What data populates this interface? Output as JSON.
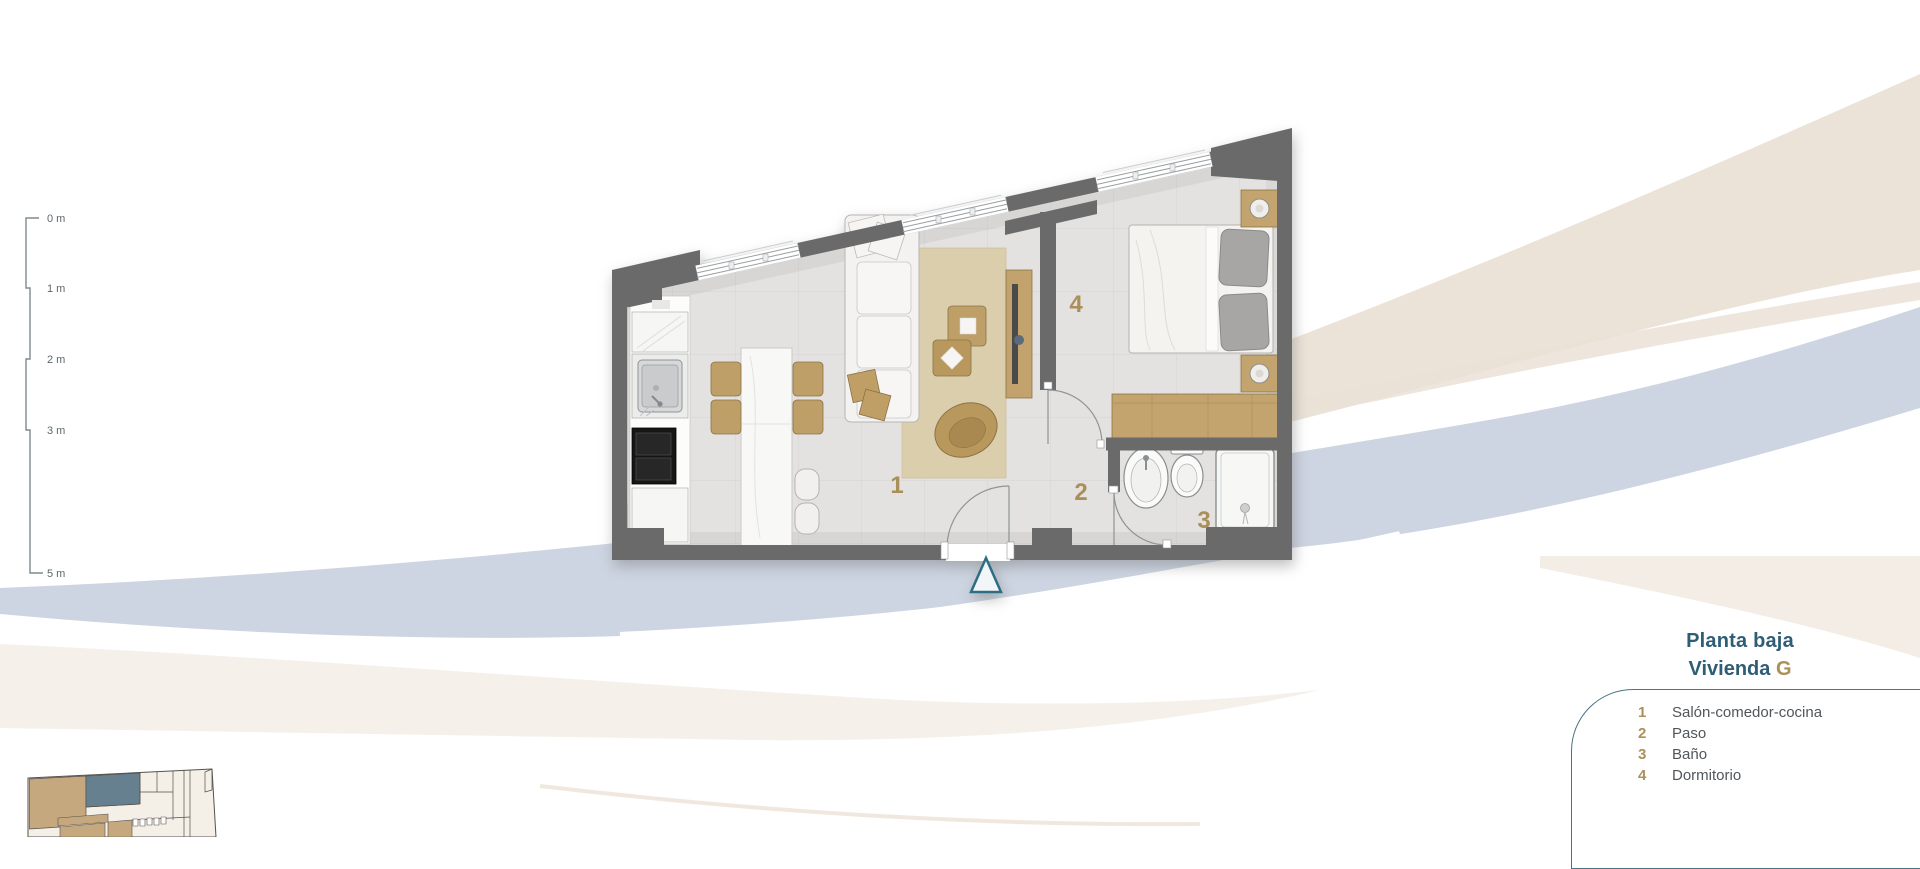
{
  "title": {
    "floor": "Planta baja",
    "unit_prefix": "Vivienda",
    "unit_letter": "G"
  },
  "legend": {
    "items": [
      {
        "number": "1",
        "label": "Salón-comedor-cocina"
      },
      {
        "number": "2",
        "label": "Paso"
      },
      {
        "number": "3",
        "label": "Baño"
      },
      {
        "number": "4",
        "label": "Dormitorio"
      }
    ]
  },
  "scale_ruler": {
    "ticks": [
      "0 m",
      "1 m",
      "2 m",
      "3 m",
      "5 m"
    ]
  },
  "floor_plan": {
    "room_numbers": {
      "salon": "1",
      "paso": "2",
      "bano": "3",
      "dormitorio": "4"
    }
  },
  "colors": {
    "teal_text": "#2E5D76",
    "gold_accent": "#AB9058",
    "wall_gray": "#6A6A6A",
    "wave_blue": "#CDD5E2",
    "wave_beige": "#ECE3D8",
    "floor_tile": "#E3E2E0",
    "rug_beige": "#DBCEAD",
    "wood_tan": "#C2A36E",
    "entrance_marker_teal": "#2D6E85",
    "legend_border_teal": "#4A7383"
  }
}
